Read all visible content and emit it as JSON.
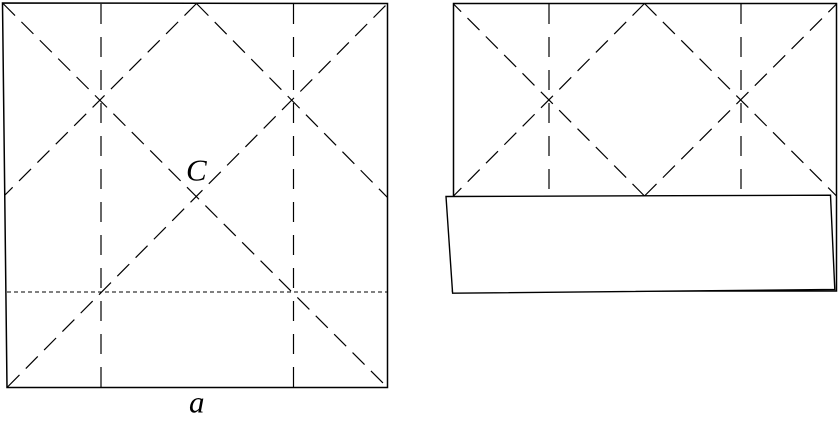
{
  "diagram": {
    "background_color": "#ffffff",
    "line_color": "#000000",
    "labels": {
      "center_point": "C",
      "square_side": "a"
    }
  }
}
